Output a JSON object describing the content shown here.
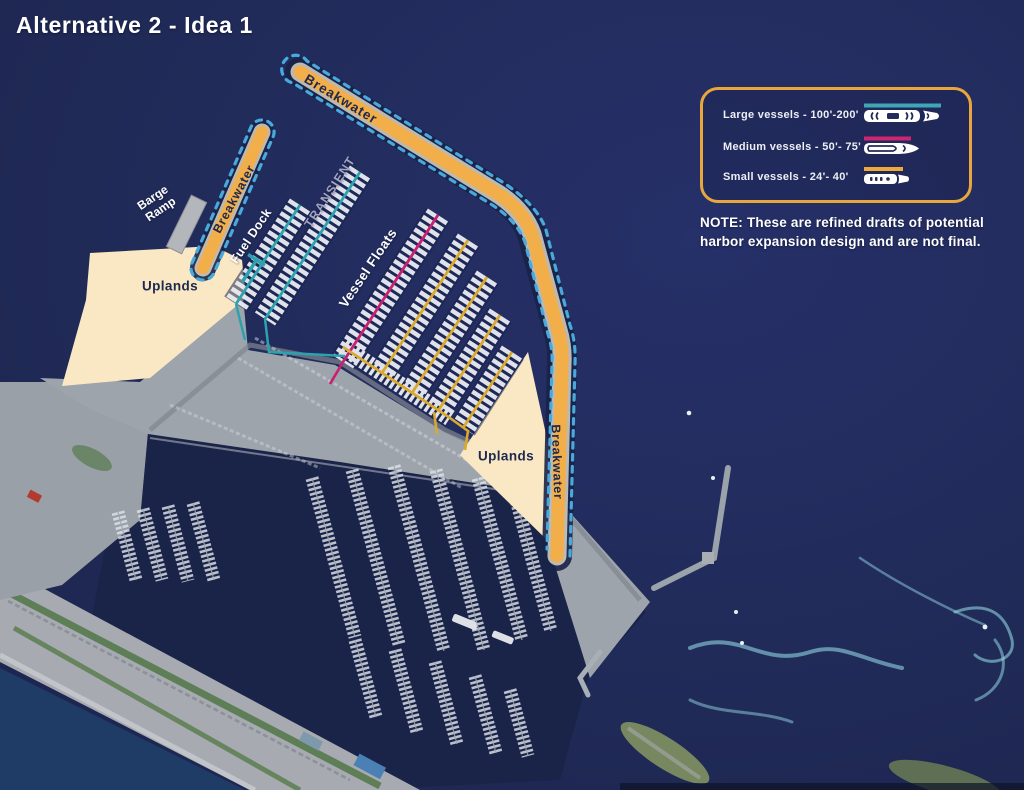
{
  "title": "Alternative 2 - Idea 1",
  "note": "NOTE: These are refined drafts of potential harbor expansion design and are not final.",
  "legend": {
    "border_color": "#E8A63C",
    "items": [
      {
        "label": "Large vessels - 100'-200'",
        "line_color": "#3FA6B5"
      },
      {
        "label": "Medium vessels - 50'- 75'",
        "line_color": "#D02571"
      },
      {
        "label": "Small vessels - 24'- 40'",
        "line_color": "#EFAA3A"
      }
    ]
  },
  "map_labels": {
    "breakwater_top": "Breakwater",
    "breakwater_left": "Breakwater",
    "breakwater_right": "Breakwater",
    "barge_ramp": "Barge Ramp",
    "fuel_dock": "Fuel Dock",
    "transient": "TRANSIENT",
    "vessel_floats": "Vessel Floats",
    "uplands_left": "Uplands",
    "uplands_right": "Uplands"
  },
  "colors": {
    "water": "#212B59",
    "inner_basin_water": "#1A2449",
    "breakwater_fill": "#F2AE48",
    "breakwater_rock_edge": "#D7D3C5",
    "breakwater_halo": "#192348",
    "outline_dash": "#49A9DD",
    "uplands_fill": "#F9E8C3",
    "large_vessel_dock": "#2BA2AE",
    "medium_vessel_dock": "#C72070",
    "small_vessel_dock": "#D9A92F",
    "label_navy": "#1E2950"
  }
}
